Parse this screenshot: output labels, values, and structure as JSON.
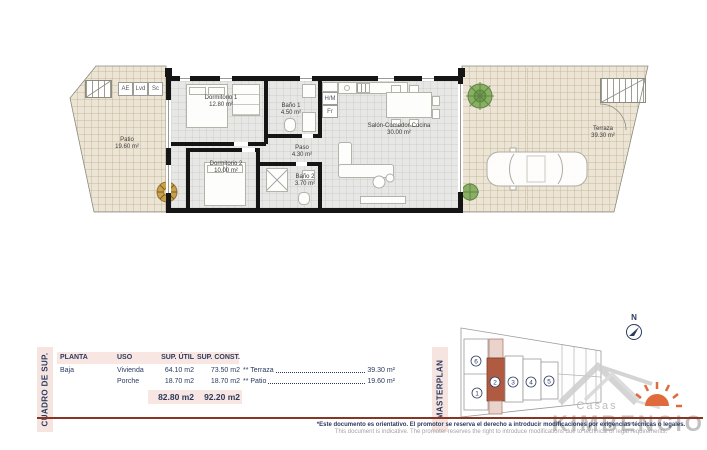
{
  "plan": {
    "closets": {
      "ae": "AE",
      "lvd": "Lvd",
      "sc": "Sc"
    },
    "kitchen": {
      "hm": "H/M",
      "fr": "Fr"
    },
    "rooms": {
      "patio": {
        "name": "Patio",
        "area": "19.60 m²"
      },
      "dormitorio1": {
        "name": "Dormitorio 1",
        "area": "12.80 m²"
      },
      "bano1": {
        "name": "Baño 1",
        "area": "4.50 m²"
      },
      "salon": {
        "name": "Salón-Comedor-Cocina",
        "area": "30.00 m²"
      },
      "paso": {
        "name": "Paso",
        "area": "4.30 m²"
      },
      "dormitorio2": {
        "name": "Dormitorio 2",
        "area": "10.00 m²"
      },
      "bano2": {
        "name": "Baño 2",
        "area": "3.70 m²"
      },
      "terraza": {
        "name": "Terraza",
        "area": "39.30 m²"
      }
    }
  },
  "surface_table": {
    "side_label": "CUADRO DE SUP.",
    "headers": {
      "planta": "PLANTA",
      "uso": "USO",
      "sup_util": "SUP. ÚTIL",
      "sup_const": "SUP. CONST."
    },
    "rows": [
      {
        "planta": "Baja",
        "uso": "Vivienda",
        "util": "64.10 m2",
        "const": "73.50 m2"
      },
      {
        "planta": "",
        "uso": "Porche",
        "util": "18.70 m2",
        "const": "18.70 m2"
      }
    ],
    "totals": {
      "util": "82.80 m2",
      "const": "92.20 m2"
    },
    "extras": [
      {
        "label": "** Terraza",
        "value": "39.30 m²"
      },
      {
        "label": "** Patio",
        "value": "19.60 m²"
      }
    ]
  },
  "masterplan": {
    "side_label": "MASTERPLAN",
    "north_label": "N",
    "highlight_color": "#b05a41",
    "units": [
      {
        "label": "1"
      },
      {
        "label": "2"
      },
      {
        "label": "3"
      },
      {
        "label": "4"
      },
      {
        "label": "5"
      },
      {
        "label": "6"
      }
    ]
  },
  "branding": {
    "name_top": "Casas",
    "name_main": "KIMBENCIO"
  },
  "footer": {
    "rule_color": "#8a3524",
    "disclaimer_es": "*Este documento es orientativo. El promotor se reserva el derecho a introducir modificaciones por exigencias técnicas o legales.",
    "disclaimer_en": "This document is indicative. The promoter reserves the right to introduce modifications due to technical or legal requirements."
  }
}
